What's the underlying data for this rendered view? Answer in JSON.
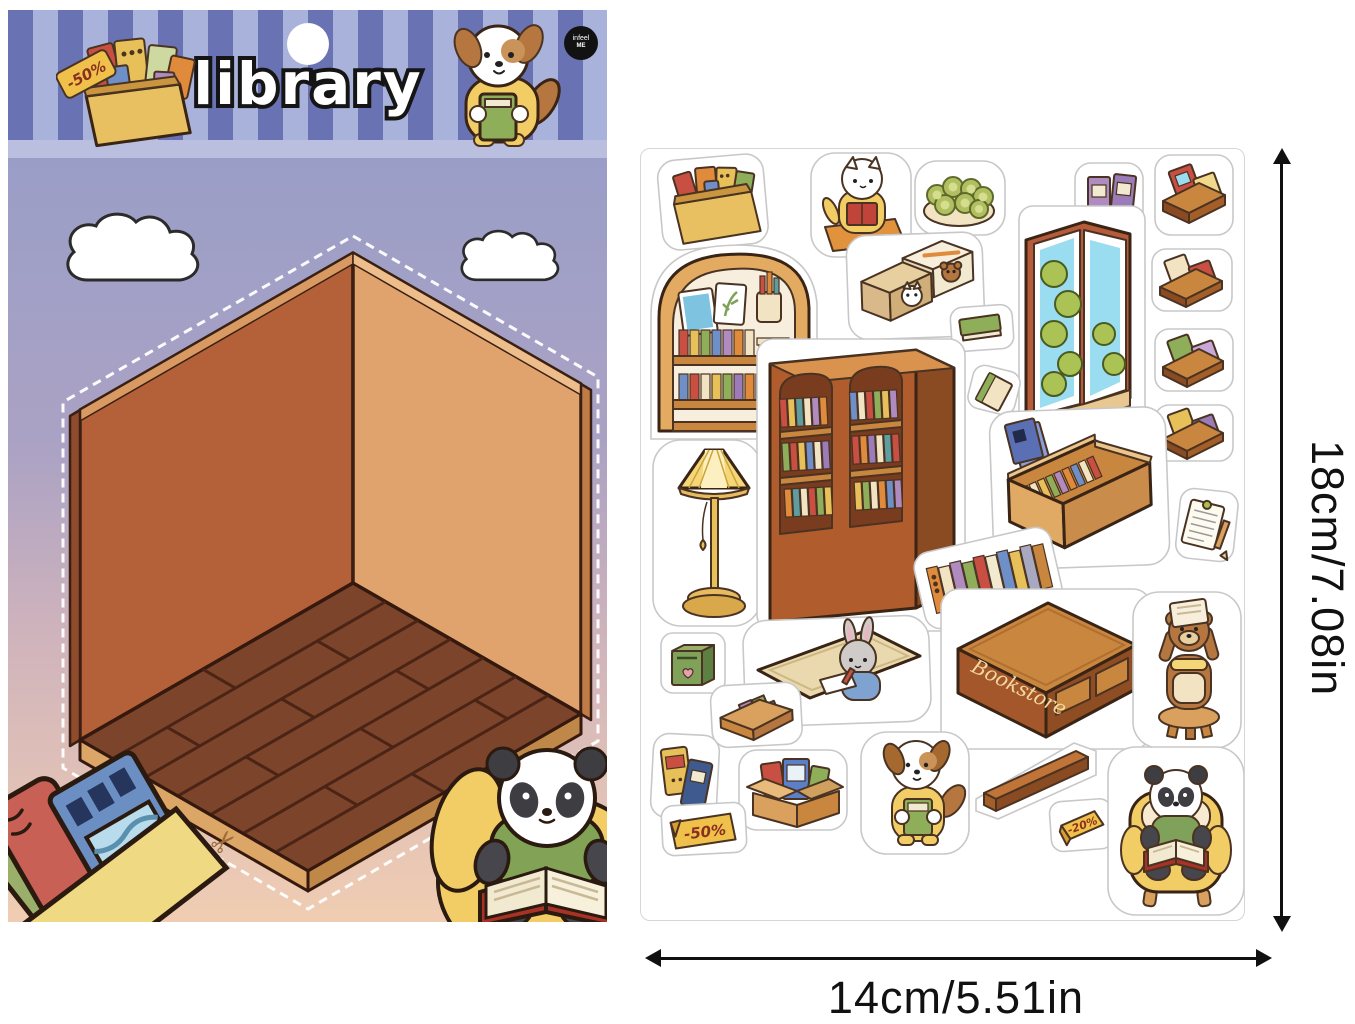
{
  "card": {
    "title": "library",
    "badge": {
      "line1": "infeel",
      "line2": "ME"
    },
    "header_sticker_tag": "-50%",
    "stickers": [
      "book-box-with-sale-tag",
      "puppy-holding-book",
      "cloud",
      "cloud",
      "isometric-room-backdrop",
      "scissors-cut-mark",
      "corner-book-box",
      "panda-reading-on-beanbag"
    ]
  },
  "sheet": {
    "tags": {
      "sale50": "-50%",
      "sale20": "-20%",
      "bookstore": "Bookstore"
    },
    "items": [
      "box-of-books",
      "cat-reading-on-cushion",
      "kiwi-bowl",
      "purple-book-pair",
      "book-display-stand-1",
      "arched-wall-shelf",
      "book-slipcases-with-animal-faces",
      "corner-window",
      "green-book",
      "book-display-stand-2",
      "book-display-stand-3",
      "tilted-book",
      "book-display-stand-4",
      "floor-lamp",
      "double-bookcase",
      "low-book-bench",
      "clipboard-note",
      "leaning-books-row",
      "green-bin",
      "rug-with-writing-rabbit",
      "bookstore-counter",
      "bear-on-stool",
      "book-tray",
      "leaning-book-pair",
      "cardboard-box-of-books",
      "sale-50-tag",
      "dog-reading",
      "wooden-plank",
      "sale-20-tent-card",
      "panda-in-armchair"
    ]
  },
  "dimensions": {
    "height_label": "18cm/7.08in",
    "width_label": "14cm/5.51in"
  },
  "colors": {
    "stripe_dark": "#6973b3",
    "stripe_light": "#a9b2da",
    "header_strip": "#babfe0",
    "wall_left": "#b4613a",
    "wall_right": "#e0a36d",
    "floor": "#7c452b",
    "sheet_border": "#d6d6d6",
    "tag_yellow": "#f0c14a",
    "tag_text": "#8a3020",
    "dimension_ink": "#101010"
  }
}
